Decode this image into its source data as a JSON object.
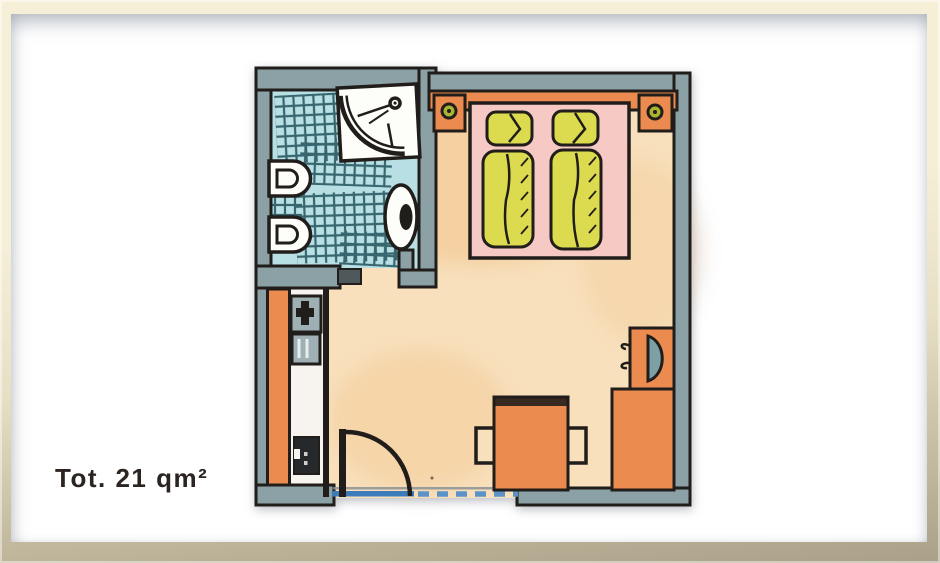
{
  "caption": {
    "text": "Tot. 21 qm²",
    "area_value": "21",
    "area_unit": "qm²"
  },
  "plan": {
    "icons": [
      "shower-icon",
      "toilet-icon",
      "bidet-icon",
      "washbasin-icon",
      "double-bed",
      "pillow",
      "duvet",
      "headboard",
      "nightstand",
      "lamp-icon",
      "wardrobe",
      "minibar-icon",
      "rack-icon",
      "safe-icon",
      "tv-icon",
      "desk",
      "chair",
      "entry-door",
      "sliding-door",
      "window"
    ]
  },
  "colors": {
    "frame_light": "#f6efd8",
    "frame_mid": "#e7dfc4",
    "frame_dark": "#a9a088",
    "matte": "#ffffff",
    "ink": "#201d1a",
    "wall": "#8ba1a6",
    "bath_floor": "#b7dfe4",
    "tile": "#2a5a63",
    "room_floor": "#f8e0bc",
    "floor_warm": "#f2c38b",
    "corridor": "#f7f4ef",
    "orange": "#ec8b50",
    "pink": "#f6c9c5",
    "yellow": "#dcda4e",
    "lamp": "#a9b431",
    "screen": "#7da0a7",
    "fixture": "#9fb0b4",
    "white_fix": "#fdfdfa",
    "win_blue": "#3c7cbb",
    "win_blue2": "#5b93c9",
    "text": "#2b2421"
  }
}
